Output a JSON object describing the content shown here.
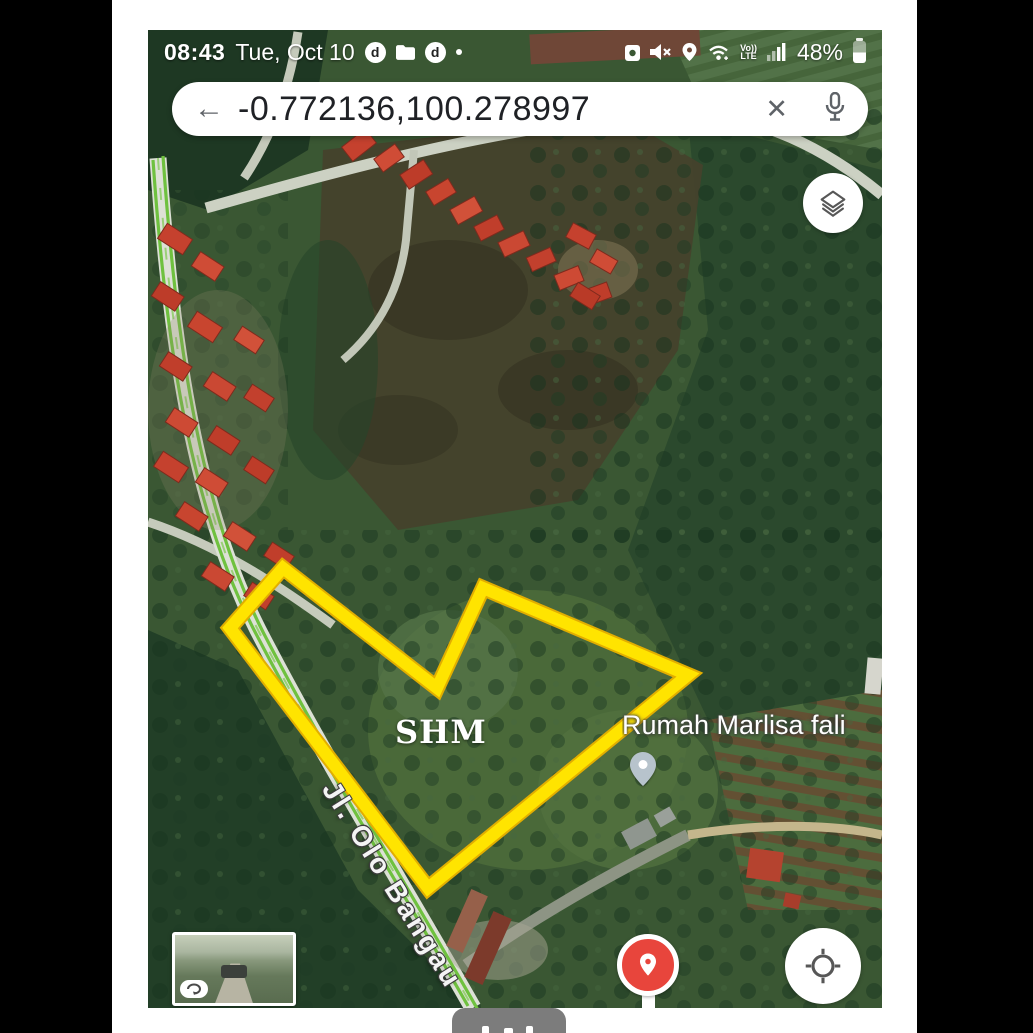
{
  "status_bar": {
    "time": "08:43",
    "date": "Tue, Oct 10",
    "badge_letter": "d",
    "battery_percent": "48%",
    "volte_top": "Vo))",
    "volte_bottom": "LTE"
  },
  "search_bar": {
    "query": "-0.772136,100.278997",
    "back_glyph": "←",
    "clear_glyph": "✕"
  },
  "map": {
    "plot_label": "SHM",
    "place_label": "Rumah Marlisa fali",
    "street_label": "Jl. Olo Bangau",
    "polygon": {
      "color": "#ffe400",
      "edge_color": "#e2ae00",
      "stroke_width": 12,
      "points_px": [
        [
          135,
          538
        ],
        [
          289,
          658
        ],
        [
          335,
          558
        ],
        [
          540,
          645
        ],
        [
          280,
          858
        ],
        [
          82,
          598
        ]
      ]
    },
    "colors": {
      "marker_red": "#e8453c",
      "road_stripe_green": "#6fc13f",
      "secondary_pin_gray": "#b7c3cc"
    }
  }
}
